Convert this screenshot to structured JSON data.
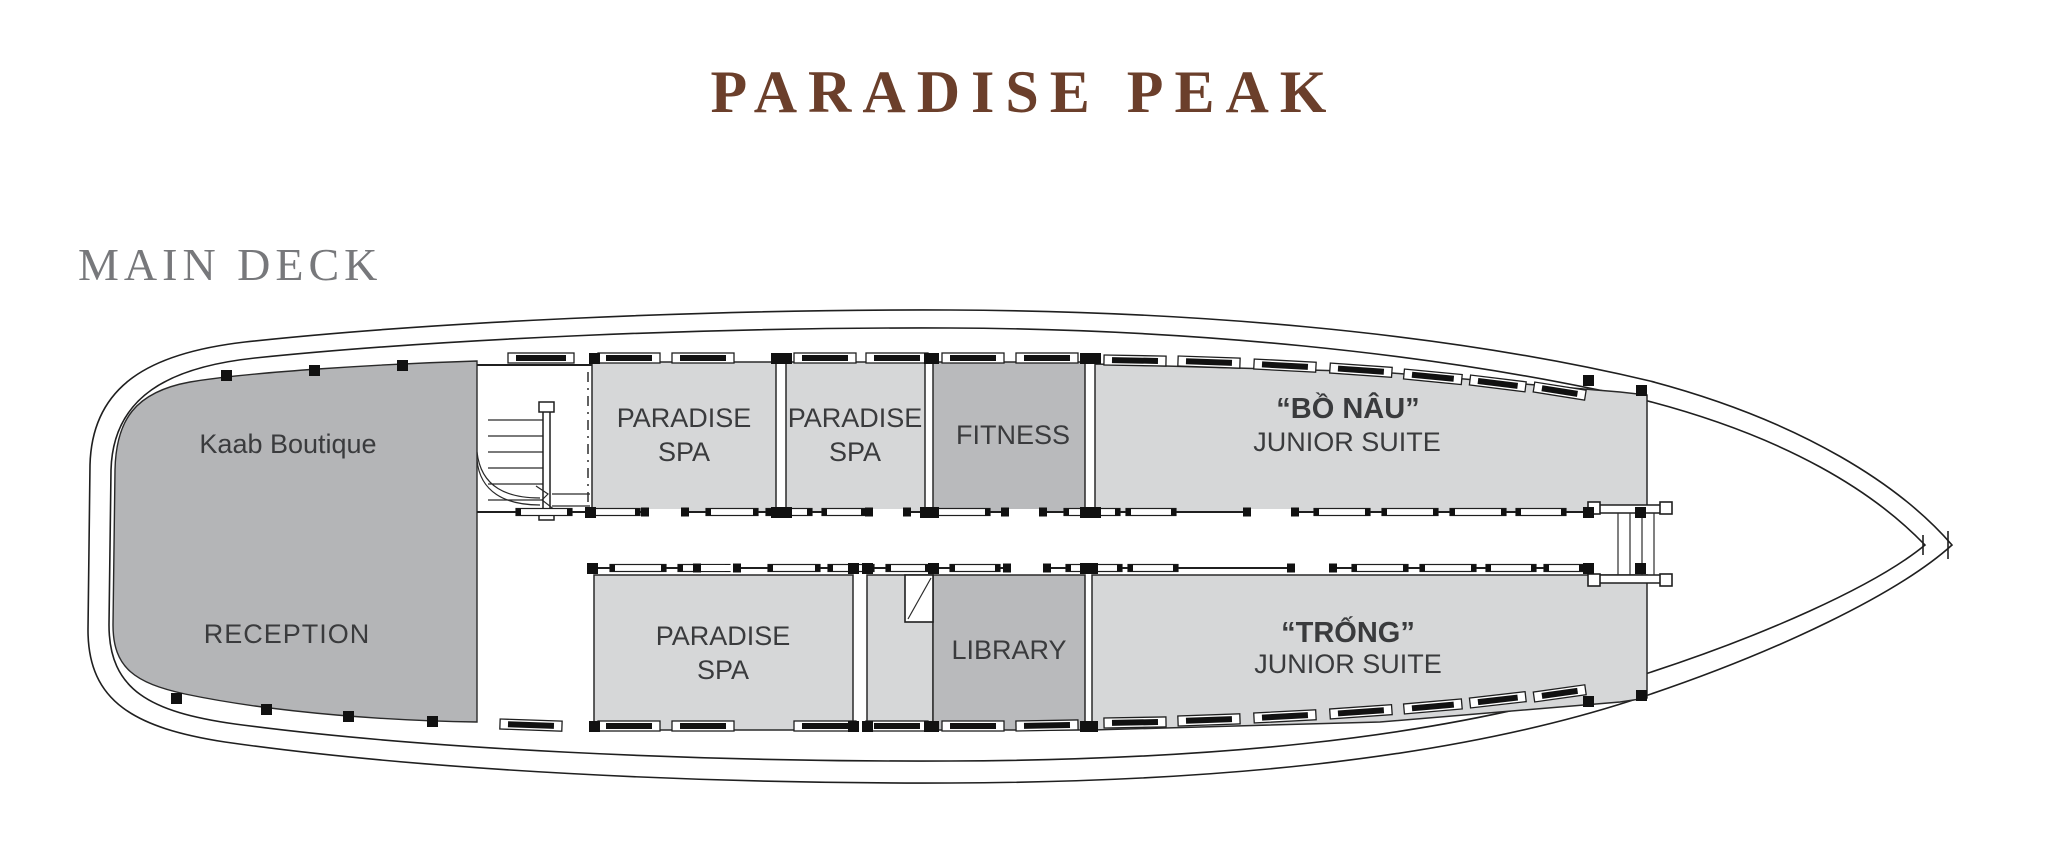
{
  "title": "PARADISE PEAK",
  "deck": {
    "label": "MAIN DECK"
  },
  "colors": {
    "title_brown": "#6b3f2b",
    "deck_label_gray": "#77787b",
    "room_light_gray": "#d6d7d8",
    "room_dark_gray": "#b9babc",
    "boutique_gray": "#b4b5b7",
    "line_black": "#1f1f1f",
    "label_text": "#3a3b3d"
  },
  "rooms": {
    "boutique": {
      "label": "Kaab Boutique"
    },
    "reception": {
      "label": "RECEPTION"
    },
    "spa_top_1": {
      "line1": "PARADISE",
      "line2": "SPA"
    },
    "spa_top_2": {
      "line1": "PARADISE",
      "line2": "SPA"
    },
    "fitness": {
      "label": "FITNESS"
    },
    "spa_bottom": {
      "line1": "PARADISE",
      "line2": "SPA"
    },
    "library": {
      "label": "LIBRARY"
    },
    "suite_bow_top": {
      "name": "“BỒ NÂU”",
      "type": "JUNIOR SUITE"
    },
    "suite_bow_bottom": {
      "name": "“TRỐNG”",
      "type": "JUNIOR SUITE"
    }
  }
}
